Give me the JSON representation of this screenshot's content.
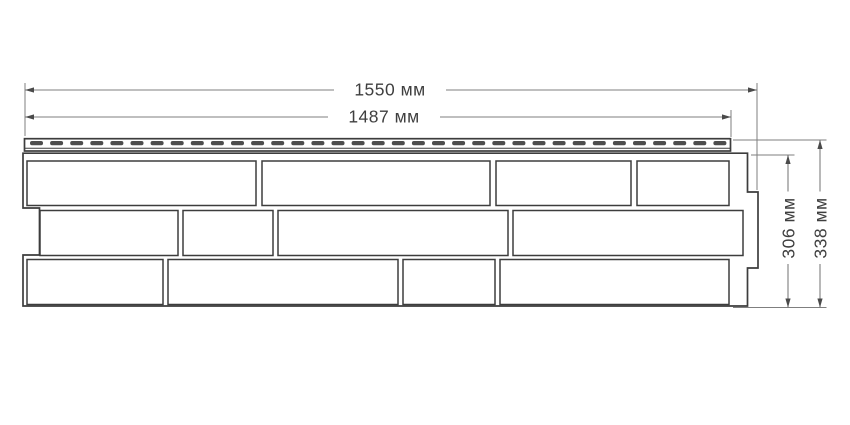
{
  "drawing": {
    "dimension_labels": {
      "overall_length": "1550 мм",
      "working_length": "1487 мм",
      "body_height": "306 мм",
      "overall_height": "338 мм"
    },
    "colors": {
      "background": "#ffffff",
      "outline": "#3d3d3d",
      "dimension_line": "#7f7f7f",
      "text": "#3f3f3f",
      "slot_fill": "#4d4d4d"
    },
    "perforation": {
      "slot_count": 35
    }
  }
}
